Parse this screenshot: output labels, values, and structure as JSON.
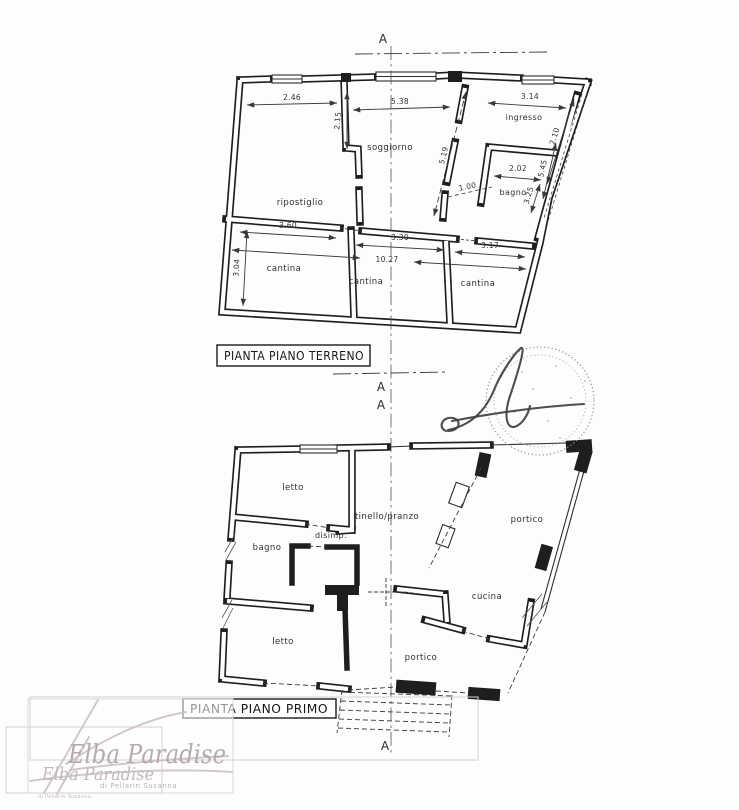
{
  "ground_floor": {
    "title": "PIANTA PIANO TERRENO",
    "rooms": {
      "ripostiglio": "ripostiglio",
      "soggiorno": "soggiorno",
      "ingresso": "ingresso",
      "bagno": "bagno",
      "cantina1": "cantina",
      "cantina2": "cantina",
      "cantina3": "cantina"
    },
    "dims": {
      "rip_w": "2.46",
      "rip_top": "2.15",
      "sog_w": "5.38",
      "sog_diag": "5.19",
      "ing_w": "3.14",
      "corridor": "2.10",
      "right_side": "5.45",
      "bagno_w": "2.02",
      "right_low": "3.25",
      "door": "1.00",
      "cant1_w": "3.60",
      "cant2_w": "3.30",
      "total_w": "10.27",
      "cant3_w": "3.17",
      "cant_h": "3.04"
    }
  },
  "first_floor": {
    "title": "PIANTA PIANO PRIMO",
    "rooms": {
      "letto1": "letto",
      "tinello": "tinello/pranzo",
      "portico1": "portico",
      "disimp": "disimp.",
      "bagno": "bagno",
      "cucina": "cucina",
      "letto2": "letto",
      "portico2": "portico"
    }
  },
  "section": {
    "marker": "A"
  },
  "watermark": {
    "brand": "Elba Paradise",
    "subtitle": "di Pellarin Susanna"
  }
}
